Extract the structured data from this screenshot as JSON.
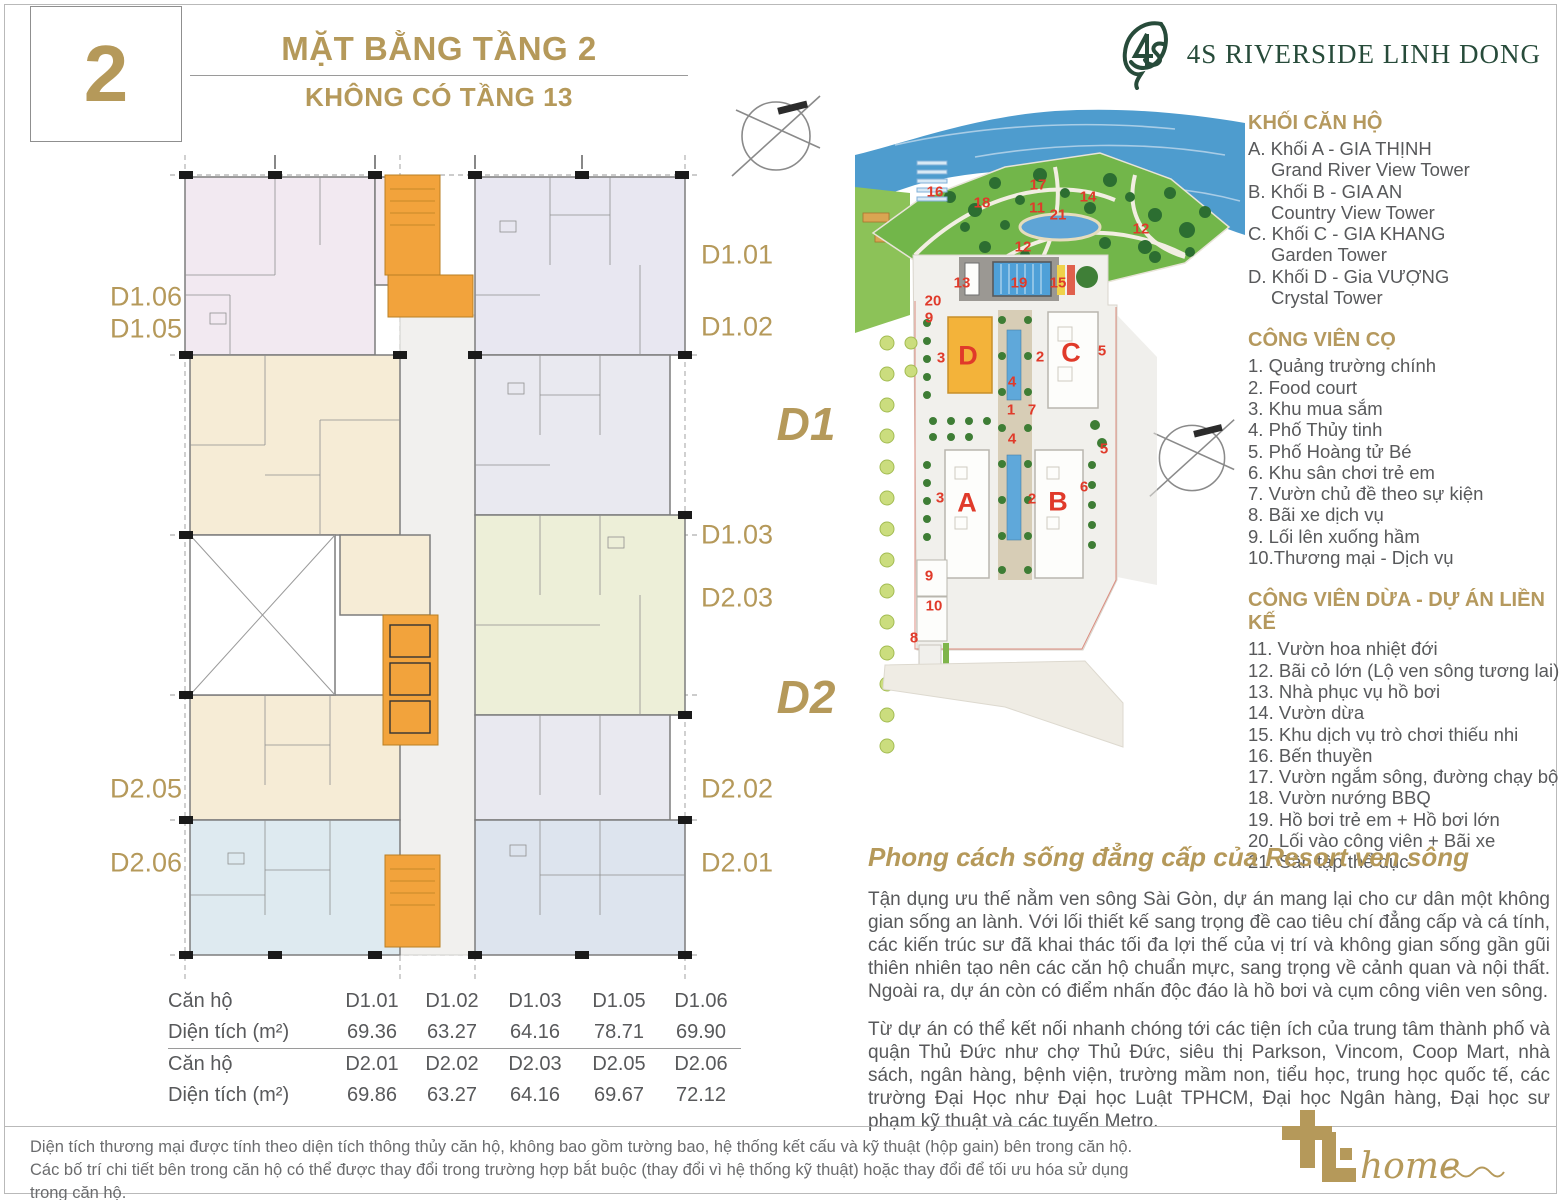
{
  "page": {
    "number": "2",
    "title": "MẶT BẰNG TẦNG 2",
    "subtitle": "KHÔNG CÓ TẦNG 13",
    "brand": "4S RIVERSIDE LINH DONG"
  },
  "colors": {
    "accent_gold": "#B5995A",
    "label_red": "#E03A2A",
    "brand_green": "#274B3A",
    "body_grey": "#58595B",
    "core_orange": "#F2A33C"
  },
  "legend": {
    "sections": [
      {
        "title": "KHỐI CĂN HỘ",
        "items": [
          {
            "text": "A. Khối A - GIA THỊNH",
            "indent": false
          },
          {
            "text": "Grand River View Tower",
            "indent": true
          },
          {
            "text": "B. Khối B - GIA AN",
            "indent": false
          },
          {
            "text": "Country View Tower",
            "indent": true
          },
          {
            "text": "C. Khối C - GIA KHANG",
            "indent": false
          },
          {
            "text": "Garden Tower",
            "indent": true
          },
          {
            "text": "D. Khối D - Gia VƯỢNG",
            "indent": false
          },
          {
            "text": "Crystal Tower",
            "indent": true
          }
        ]
      },
      {
        "title": "CÔNG VIÊN CỌ",
        "items": [
          {
            "text": "1. Quảng trường chính",
            "indent": false
          },
          {
            "text": "2. Food court",
            "indent": false
          },
          {
            "text": "3. Khu mua sắm",
            "indent": false
          },
          {
            "text": "4. Phố Thủy tinh",
            "indent": false
          },
          {
            "text": "5. Phố Hoàng tử Bé",
            "indent": false
          },
          {
            "text": "6. Khu sân chơi trẻ em",
            "indent": false
          },
          {
            "text": "7. Vườn chủ đề theo sự kiện",
            "indent": false
          },
          {
            "text": "8. Bãi xe dịch vụ",
            "indent": false
          },
          {
            "text": "9. Lối lên xuống hầm",
            "indent": false
          },
          {
            "text": "10.Thương mại - Dịch vụ",
            "indent": false
          }
        ]
      },
      {
        "title": "CÔNG VIÊN DỪA - DỰ ÁN LIỀN KẾ",
        "items": [
          {
            "text": "11. Vườn hoa nhiệt đới",
            "indent": false
          },
          {
            "text": "12. Bãi cỏ lớn (Lộ ven sông tương lai)",
            "indent": false
          },
          {
            "text": "13. Nhà phục vụ hồ bơi",
            "indent": false
          },
          {
            "text": "14. Vườn dừa",
            "indent": false
          },
          {
            "text": "15. Khu dịch vụ trò chơi thiếu nhi",
            "indent": false
          },
          {
            "text": "16. Bến thuyền",
            "indent": false
          },
          {
            "text": "17. Vườn ngắm sông, đường chạy bộ",
            "indent": false
          },
          {
            "text": "18. Vườn nướng BBQ",
            "indent": false
          },
          {
            "text": "19. Hồ bơi trẻ em + Hồ bơi lớn",
            "indent": false
          },
          {
            "text": "20. Lối vào công viên + Bãi xe",
            "indent": false
          },
          {
            "text": "21. Sân tập thể dục",
            "indent": false
          }
        ]
      }
    ]
  },
  "highlights": {
    "heading": "Phong cách sống đẳng cấp của Resort ven sông",
    "paragraph1": "Tận dụng ưu thế nằm ven sông Sài Gòn, dự án mang lại cho cư dân một không gian sống an lành. Với lối thiết kế sang trọng đề cao tiêu chí đẳng cấp và cá tính, các kiến trúc sư đã khai thác tối đa lợi thế của vị trí và không gian sống gần gũi thiên nhiên tạo nên các căn hộ chuẩn mực, sang trọng về cảnh quan và nội thất. Ngoài ra, dự án còn có điểm nhấn độc đáo là hồ bơi và cụm công viên ven sông.",
    "paragraph2": "Từ dự án có thể kết nối nhanh chóng tới các tiện ích của trung tâm thành phố và quận Thủ Đức như chợ Thủ Đức, siêu thị Parkson, Vincom, Coop Mart, nhà sách, ngân hàng, bệnh viện, trường mầm non, tiểu học, trung học quốc tế, các trường Đại Học như Đại học Luật TPHCM, Đại học Ngân hàng, Đại học sư phạm kỹ thuật và các tuyến Metro."
  },
  "table": {
    "rows": [
      {
        "label": "Căn hộ",
        "values": [
          "D1.01",
          "D1.02",
          "D1.03",
          "D1.05",
          "D1.06"
        ],
        "separator": false
      },
      {
        "label": "Diện tích (m²)",
        "values": [
          "69.36",
          "63.27",
          "64.16",
          "78.71",
          "69.90"
        ],
        "separator": true
      },
      {
        "label": "Căn hộ",
        "values": [
          "D2.01",
          "D2.02",
          "D2.03",
          "D2.05",
          "D2.06"
        ],
        "separator": false
      },
      {
        "label": "Diện tích (m²)",
        "values": [
          "69.86",
          "63.27",
          "64.16",
          "69.67",
          "72.12"
        ],
        "separator": false
      }
    ]
  },
  "floor_plan": {
    "unit_labels": [
      {
        "label": "D1.06",
        "x": 146,
        "y": 297
      },
      {
        "label": "D1.05",
        "x": 146,
        "y": 329
      },
      {
        "label": "D2.05",
        "x": 146,
        "y": 789
      },
      {
        "label": "D2.06",
        "x": 146,
        "y": 863
      },
      {
        "label": "D1.01",
        "x": 737,
        "y": 255
      },
      {
        "label": "D1.02",
        "x": 737,
        "y": 327
      },
      {
        "label": "D1.03",
        "x": 737,
        "y": 535
      },
      {
        "label": "D2.03",
        "x": 737,
        "y": 598
      },
      {
        "label": "D2.02",
        "x": 737,
        "y": 789
      },
      {
        "label": "D2.01",
        "x": 737,
        "y": 863
      }
    ]
  },
  "site_plan": {
    "zone_labels": [
      {
        "label": "D1",
        "x": 806,
        "y": 424
      },
      {
        "label": "D2",
        "x": 806,
        "y": 697
      }
    ],
    "building_labels": [
      {
        "label": "D",
        "x": 968,
        "y": 356
      },
      {
        "label": "C",
        "x": 1071,
        "y": 353
      },
      {
        "label": "A",
        "x": 967,
        "y": 503
      },
      {
        "label": "B",
        "x": 1058,
        "y": 502
      }
    ],
    "point_labels": [
      {
        "label": "16",
        "x": 935,
        "y": 192
      },
      {
        "label": "18",
        "x": 982,
        "y": 203
      },
      {
        "label": "17",
        "x": 1038,
        "y": 185
      },
      {
        "label": "11",
        "x": 1037,
        "y": 208
      },
      {
        "label": "21",
        "x": 1058,
        "y": 215
      },
      {
        "label": "14",
        "x": 1088,
        "y": 197
      },
      {
        "label": "12",
        "x": 1141,
        "y": 229
      },
      {
        "label": "12",
        "x": 1023,
        "y": 247
      },
      {
        "label": "13",
        "x": 962,
        "y": 283
      },
      {
        "label": "19",
        "x": 1019,
        "y": 283
      },
      {
        "label": "15",
        "x": 1058,
        "y": 283
      },
      {
        "label": "20",
        "x": 933,
        "y": 301
      },
      {
        "label": "9",
        "x": 929,
        "y": 318
      },
      {
        "label": "3",
        "x": 941,
        "y": 358
      },
      {
        "label": "2",
        "x": 1040,
        "y": 357
      },
      {
        "label": "5",
        "x": 1102,
        "y": 351
      },
      {
        "label": "4",
        "x": 1012,
        "y": 382
      },
      {
        "label": "1",
        "x": 1011,
        "y": 410
      },
      {
        "label": "7",
        "x": 1032,
        "y": 410
      },
      {
        "label": "4",
        "x": 1012,
        "y": 439
      },
      {
        "label": "5",
        "x": 1104,
        "y": 449
      },
      {
        "label": "6",
        "x": 1084,
        "y": 487
      },
      {
        "label": "3",
        "x": 940,
        "y": 498
      },
      {
        "label": "2",
        "x": 1032,
        "y": 499
      },
      {
        "label": "9",
        "x": 929,
        "y": 576
      },
      {
        "label": "10",
        "x": 934,
        "y": 606
      },
      {
        "label": "8",
        "x": 914,
        "y": 638
      }
    ]
  },
  "footer": {
    "line1": "Diện tích thương mại được tính theo diện tích thông thủy căn hộ, không bao gồm tường bao, hệ thống kết cấu và kỹ thuật (hộp gain) bên trong căn hộ.",
    "line2": "Các bố trí chi tiết bên trong căn hộ có thể được thay đổi trong trường hợp bắt buộc (thay đổi vì hệ thống kỹ thuật) hoặc thay đổi để tối ưu hóa sử dụng trong căn hộ.",
    "logo_text": "home"
  }
}
